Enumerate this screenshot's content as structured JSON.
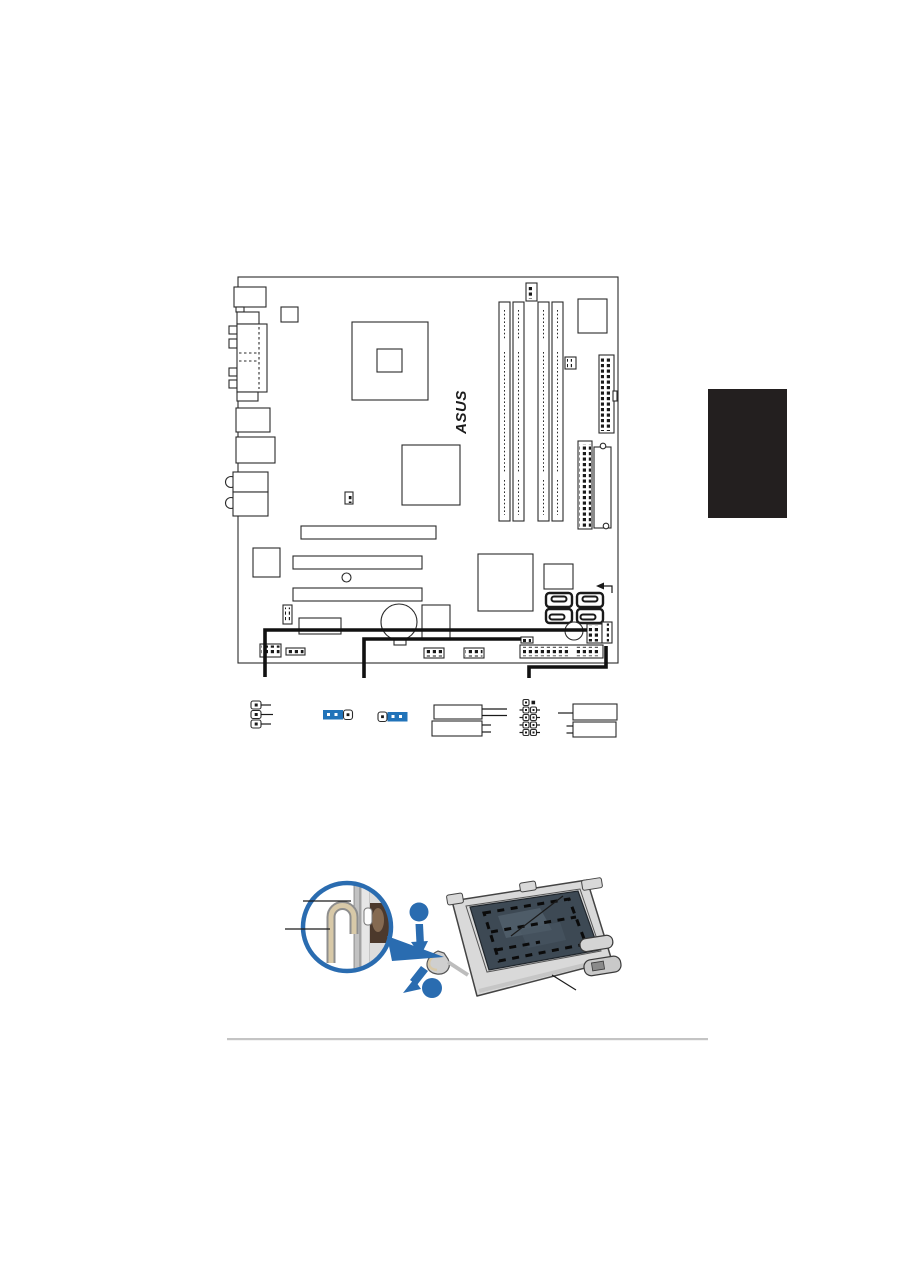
{
  "page": {
    "background": "#ffffff",
    "footer_rule_color": "#c4c4c4",
    "side_tab_color": "#231f1f"
  },
  "board_figure": {
    "logo_text": "ASUS",
    "line_color": "#2a2a2a",
    "thick_callout_color": "#111111",
    "jumper_cap_color": "#2173b9"
  },
  "cpu_figure": {
    "accent_blue": "#2a6cb0",
    "socket_plate_color": "#3d4954",
    "metal_color": "#d9d9d9",
    "lever_highlight": "#d8c9a8",
    "magnifier_detail_brown": "#4c392c"
  }
}
